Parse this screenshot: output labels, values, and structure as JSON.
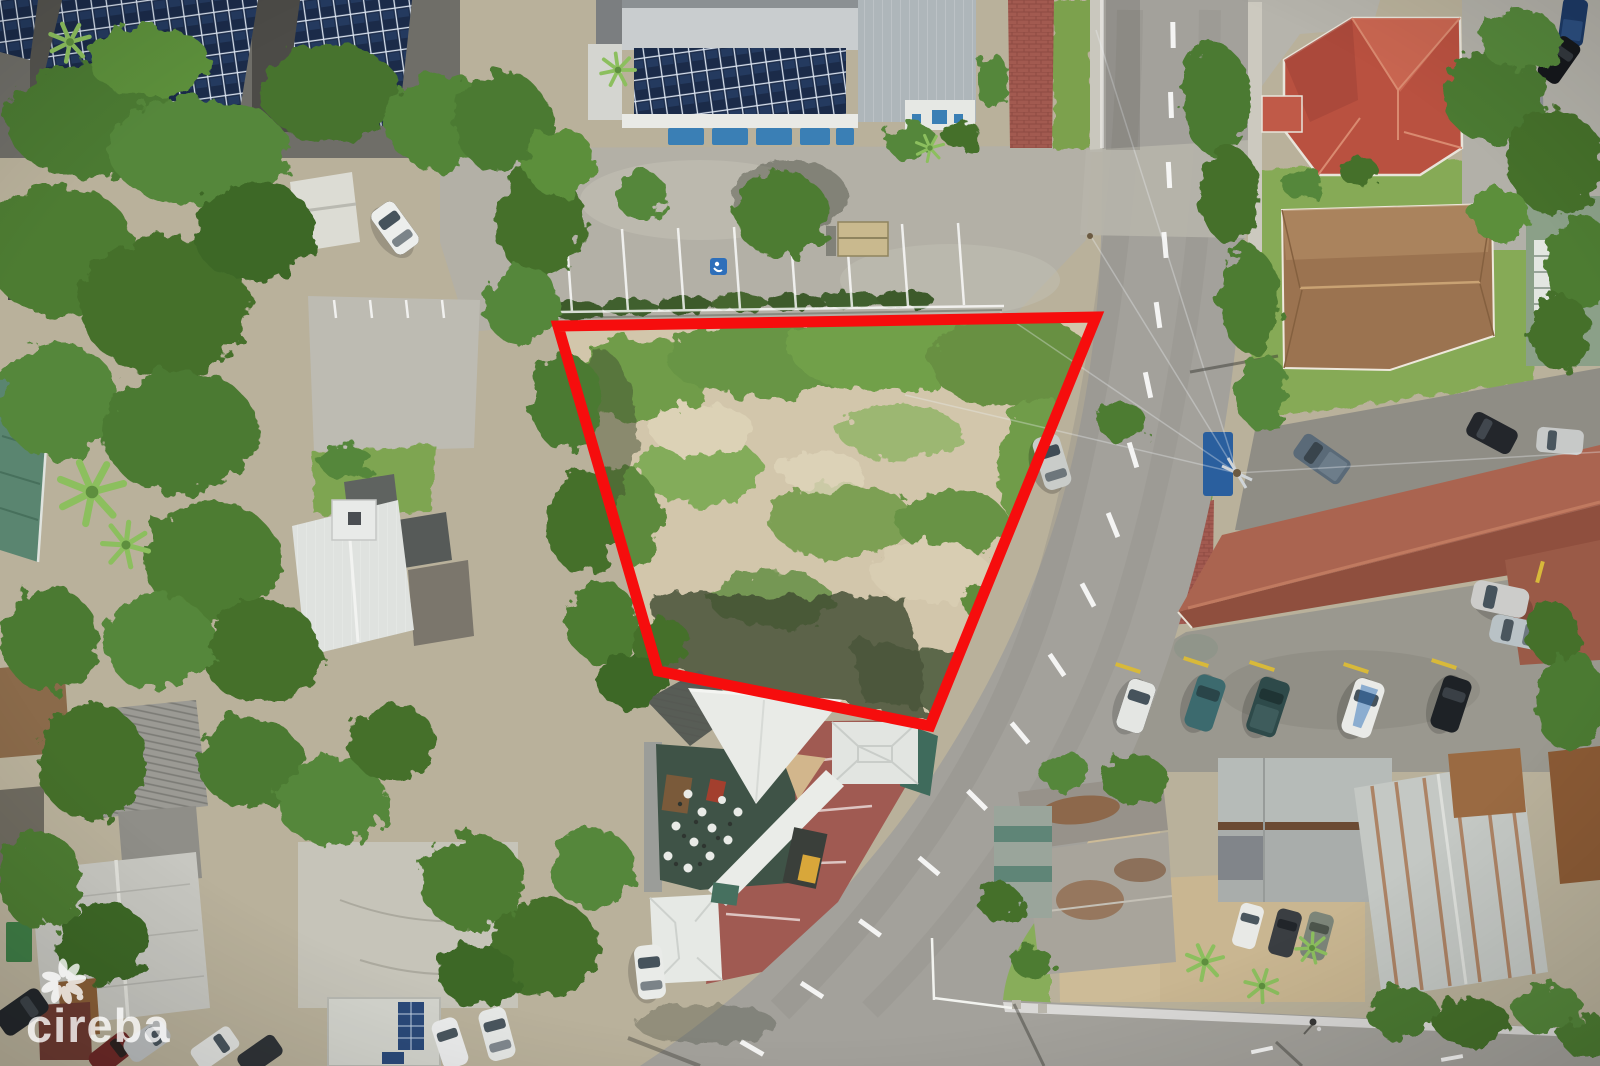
{
  "image": {
    "type": "aerial-drone-photo",
    "width": 1600,
    "height": 1066,
    "subject": "top-down drone view of a village block with a vacant corner land parcel outlined in red beside a curving two-lane road"
  },
  "watermark": {
    "text": "cireba",
    "icon": "flower-petal-logo-icon",
    "color": "#ffffff",
    "opacity": 0.78
  },
  "lot": {
    "boundary_points": "558,326 1096,317 930,726 658,671",
    "stroke_color": "#f60d0d",
    "stroke_width": 11,
    "fill": "none",
    "ground_color": "#d2c6ab",
    "vegetation_color": "#6f9c48",
    "description": "vacant sandy parcel with scrub vegetation outlined in red"
  },
  "roads": {
    "main_road": "two-lane asphalt road curving from top edge to bottom-left",
    "side_road": "side road running along the bottom-right",
    "asphalt_color": "#a3a19b",
    "marking_color": "#ffffff"
  },
  "landmarks": [
    {
      "name": "solar-roof-carports-top-left",
      "color": "#1b2b49"
    },
    {
      "name": "solar-roof-hall-top-center",
      "color": "#1b2b49"
    },
    {
      "name": "blue-awnings-row",
      "color": "#3a7fb5"
    },
    {
      "name": "parking-lot-top-center",
      "color": "#b3b0a6"
    },
    {
      "name": "handicap-parking-symbol",
      "color": "#2e6fba"
    },
    {
      "name": "red-hip-roof-house-top-right",
      "color": "#bf5443"
    },
    {
      "name": "brown-hip-roof-house-right",
      "color": "#9b7350"
    },
    {
      "name": "long-terracotta-roof-motel",
      "color": "#a05a47"
    },
    {
      "name": "motel-guest-parking",
      "color": "#9a988f"
    },
    {
      "name": "restaurant-white-roofs-and-deck",
      "color": "#e9ebe7"
    },
    {
      "name": "restaurant-red-paved-parking",
      "color": "#a05a52"
    },
    {
      "name": "white-metal-roof-house-left",
      "color": "#dfe2df"
    },
    {
      "name": "green-metal-roof-building-left-edge",
      "color": "#5a8570"
    },
    {
      "name": "corrugated-metal-roofs-bottom-left",
      "color": "#c7c7c1"
    },
    {
      "name": "gray-shingle-house-bottom-right",
      "color": "#a9adab"
    },
    {
      "name": "rusty-warehouse-roof-bottom-right",
      "color": "#c4c8c4"
    },
    {
      "name": "red-brick-walkways",
      "color": "#a25a50"
    },
    {
      "name": "utility-pole-with-wires",
      "color": "#cfd4d8"
    },
    {
      "name": "pedestrian-on-road",
      "color": "#3a3a3a"
    }
  ],
  "vehicles": {
    "car_on_road": 1,
    "clusters": [
      "white car top-left driveway",
      "row of cars on right parking strip",
      "five cars at motel parking",
      "three cars bottom-right driveway",
      "cars bottom-left street",
      "white cars bottom-center"
    ]
  }
}
